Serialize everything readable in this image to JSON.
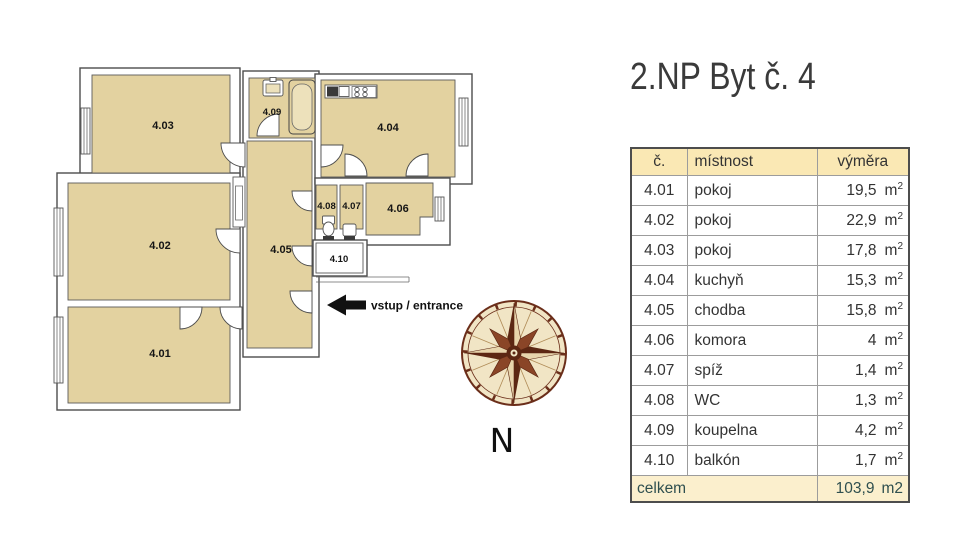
{
  "title": "2.NP Byt č. 4",
  "compass": {
    "label": "N"
  },
  "entrance": {
    "label": "vstup / entrance"
  },
  "floorplan": {
    "rooms": [
      {
        "id": "4.01"
      },
      {
        "id": "4.02"
      },
      {
        "id": "4.03"
      },
      {
        "id": "4.04"
      },
      {
        "id": "4.05"
      },
      {
        "id": "4.06"
      },
      {
        "id": "4.07"
      },
      {
        "id": "4.08"
      },
      {
        "id": "4.09"
      },
      {
        "id": "4.10"
      }
    ]
  },
  "table": {
    "headers": {
      "id": "č.",
      "name": "místnost",
      "area": "výměra"
    },
    "unit_base": "m",
    "unit_sup": "2",
    "rows": [
      {
        "id": "4.01",
        "name": "pokoj",
        "area": "19,5"
      },
      {
        "id": "4.02",
        "name": "pokoj",
        "area": "22,9"
      },
      {
        "id": "4.03",
        "name": "pokoj",
        "area": "17,8"
      },
      {
        "id": "4.04",
        "name": "kuchyň",
        "area": "15,3"
      },
      {
        "id": "4.05",
        "name": "chodba",
        "area": "15,8"
      },
      {
        "id": "4.06",
        "name": "komora",
        "area": "4"
      },
      {
        "id": "4.07",
        "name": "spíž",
        "area": "1,4"
      },
      {
        "id": "4.08",
        "name": "WC",
        "area": "1,3"
      },
      {
        "id": "4.09",
        "name": "koupelna",
        "area": "4,2"
      },
      {
        "id": "4.10",
        "name": "balkón",
        "area": "1,7"
      }
    ],
    "total_label": "celkem",
    "total_value": "103,9",
    "total_unit": "m2"
  },
  "colors": {
    "room_fill": "#E3D2A0",
    "wall_line": "#4D4D4D",
    "table_header_bg": "#FAE8B4",
    "table_footer_bg": "#FBEFCD",
    "table_border": "#4D4D4D",
    "grid_line": "#9C9C9C",
    "total_text": "#2F4F4F",
    "compass_dark": "#5C2713",
    "compass_mid": "#8A4527",
    "compass_cream": "#F1E5C5",
    "arrow": "#111111"
  }
}
